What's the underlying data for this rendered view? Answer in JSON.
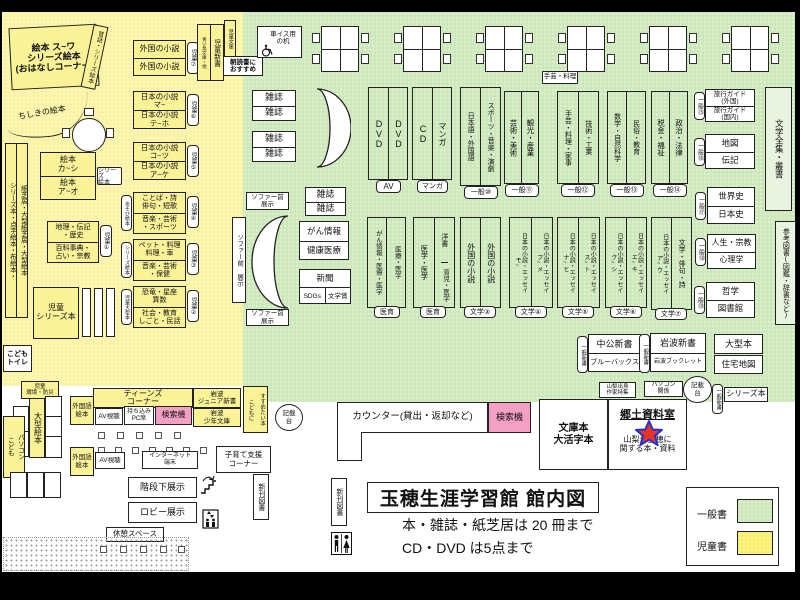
{
  "title": {
    "main": "玉穂生涯学習館 館内図",
    "note1": "本・雑誌・紙芝居は 20 冊まで",
    "note2": "CD・DVD は5点まで"
  },
  "legend": {
    "general": "一般書",
    "children": "児童書"
  },
  "colors": {
    "children_area": "#f9f3a3",
    "general_area": "#cde9bb",
    "children_box": "#faf297",
    "search_machine": "#f49fc4",
    "star_fill": "#e8332a",
    "star_border": "#2233cc"
  },
  "labels": {
    "ohanashi": "絵本 ス~ワ\nシリーズ絵本\n(おはなしコーナー)",
    "mukashi": "昔話・シリーズ絵本",
    "chishiki": "ちしきの絵本",
    "j7a": "外国の小説",
    "j7b": "外国の小説",
    "tag_j7": "児童⑦",
    "j6a": "日本の小説\nマ~",
    "j6b": "日本の小説\nテ~ホ",
    "tag_j6": "児童⑥",
    "j5a": "日本の小説\nコ~ツ",
    "j5b": "日本の小説\nア~ケ",
    "tag_j5": "児童⑤",
    "j4a": "ことば・詩\n俳句・短歌",
    "j4b": "音楽・芸術\n・スポーツ",
    "tag_j4": "児童④",
    "tag_asobi": "あそび絵本",
    "j3a": "ペット・料理\n料理・車",
    "j3b": "音楽・芸術\n・保健",
    "tag_j3": "児童③",
    "tag_serieseh2": "シリーズ絵本",
    "j2a": "恐竜・星座\n算数",
    "j2b": "社会・教育\nしごと・民話",
    "tag_j2": "児童②",
    "tag_jogata": "児童大型本",
    "ehon_ka": "絵本\nカ~シ",
    "ehon_ao": "絵本\nア~オ",
    "tag_serieseh": "シリーズ\n絵本",
    "tall_left": "シリーズ本・点字絵本・布絵本・",
    "tall_right": "紙芝居・大型紙芝居・大型絵本",
    "j1a": "地理・伝記\n・歴史",
    "j1b": "百科事典・\n占い・宗教",
    "tag_j1": "児童①",
    "jseries": "児童\nシリーズ本",
    "ktoilet": "こども\nトイレ",
    "jkankyo": "児童\n環境・防災",
    "ogataehon": "大型絵本",
    "kpc_a": "こども",
    "kpc_b": "パソコン",
    "gaikokugo": "外国語\n絵本",
    "teens": "ティーンズ\nコーナー",
    "av": "AV視聴",
    "mochikomi": "持ち込み\nPC席",
    "kensaku": "検索機",
    "iwjr": "岩波\nジュニア新書",
    "iwsn": "岩波\n少年文庫",
    "susume_a": "こどもに",
    "susume_b": "すすめたい本",
    "kisaidai": "記載\n台",
    "internet": "インターネット\n端末",
    "kosodate": "子育て支援\nコーナー",
    "kaidan": "階段下展示",
    "lobby": "ロビー展示",
    "kyukei": "休憩スペース",
    "shinkan": "新刊図書",
    "aoitori": "青い鳥文庫・他",
    "jshinsho": "児童新書",
    "jbunko": "児童文庫",
    "asadoku": "朝読書に\nおすすめ",
    "kurumaisu": "車イス用\nの机",
    "zasshi": "雑誌",
    "dvd": "DVD",
    "cd": "CD",
    "manga": "マンガ",
    "tag_av": "AV",
    "tag_manga": "マンガ",
    "g10l": "日本語・外国語",
    "g10r": "スポーツ・音楽・演劇",
    "tag_g10": "一般⑩",
    "shugei": "手芸・料理",
    "g11l": "芸術・美術",
    "g11r": "観光・産業",
    "tag_g11": "一般⑪",
    "g12l": "手芸・料理・家事",
    "g12r": "技術・工業",
    "tag_g12": "一般⑫",
    "g13l": "数学・自然科学",
    "g13r": "民俗・教育",
    "tag_g13": "一般⑬",
    "g14l": "税金・福祉",
    "g14r": "政治・法律",
    "tag_g14": "一般⑭",
    "ryogai": "旅行ガイド\n(外国)",
    "ryokoku": "旅行ガイド\n(国内)",
    "tag_g15": "一般⑮",
    "chizu": "地図",
    "denki": "伝記",
    "tag_g16": "一般⑯",
    "zenshu": "文学全集・叢書",
    "sekaishi": "世界史",
    "nihonshi": "日本史",
    "tag_g17": "一般⑰",
    "jinsei": "人生・宗教",
    "shinri": "心理学",
    "tag_g18": "一般⑱",
    "tetsu": "哲学",
    "tosho": "図書館",
    "tag_g19": "一般⑲",
    "sanko": "参考図書(図鑑・辞書など)",
    "sofa_h": "ソファー前\n展示",
    "sofa_v": "ソファー前 展示",
    "gan": "がん情報",
    "kenko": "健康医療",
    "shinbun": "新聞",
    "sdgs": "SDGs",
    "bungakusho": "文学賞",
    "iikual": "がん情報・医療・医学",
    "iikuar": "医療・医学",
    "tag_iiku": "医育",
    "iikubl": "医学・医学",
    "iikubr1": "洋書",
    "iikubr2": "育児・医学",
    "b3l": "外国の小説",
    "b3r": "外国の小説",
    "tag_b3": "文学③",
    "b4l": "日本の小説・エッセイ\nモ~",
    "b4r": "日本の小説・エッセイ\nフ~メ",
    "tag_b4": "文学④",
    "b5l": "日本の小説・エッセイ\nナ~ヒ",
    "b5r": "日本の小説・エッセイ\nス~ト",
    "tag_b5": "文学⑤",
    "b6l": "日本の小説・エッセイ\nク~シ",
    "b6r": "日本の小説・エッセイ\nエ~キ",
    "tag_b6": "文学⑥",
    "b7l": "日本の小説・エッセイ\nア~ウ",
    "b7r": "文学・俳句・詩",
    "tag_b7": "文学⑦",
    "chuko": "中公新書",
    "blueb": "ブルーバックス",
    "tag_gshinsho": "一般新書",
    "iwshin": "岩波新書",
    "iwbook": "岩波ブックレット",
    "ogatabon": "大型本",
    "jutaku": "住宅地図",
    "yamanashi": "山梨出身\n作家特集",
    "pckankei": "パソコン\n関係",
    "seriesbon": "シリーズ本",
    "bunkobon": "文庫本\n大活字本",
    "kyodo": "郷土資料室",
    "kyodotxt": "山梨や玉穂に\n関する本・資料",
    "counter": "カウンター(貸出・返却など)"
  }
}
